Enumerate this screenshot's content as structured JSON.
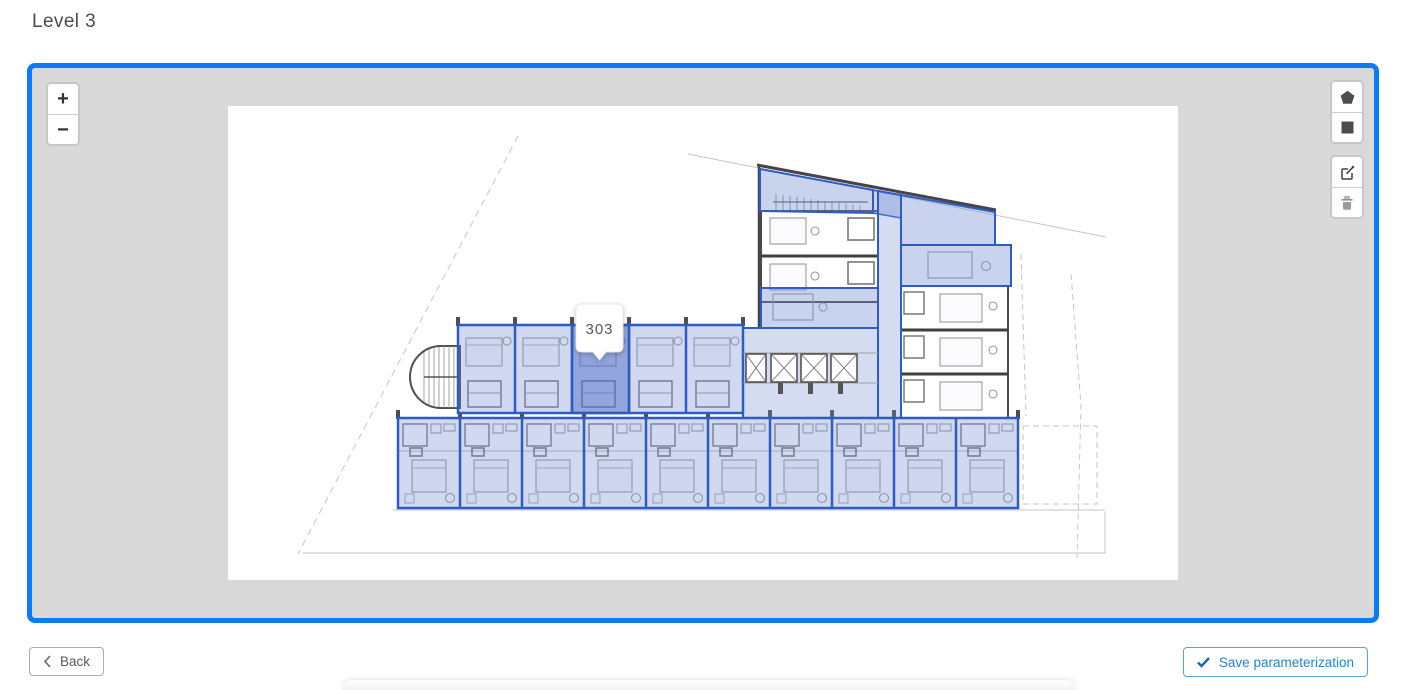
{
  "page": {
    "title": "Level 3"
  },
  "map": {
    "zoom": {
      "in_label": "+",
      "out_label": "−"
    },
    "tooltip": {
      "room_label": "303"
    },
    "tools": {
      "polygon": "draw-polygon",
      "rectangle": "draw-rectangle",
      "edit": "edit-layers",
      "delete": "delete-layers"
    }
  },
  "footer": {
    "back_label": "Back",
    "save_label": "Save parameterization"
  },
  "colors": {
    "map_border": "#0a7cf7",
    "map_background": "#d9d9d9",
    "room_highlight_stroke": "#2e5bc6",
    "room_highlight_fill": "rgba(112,140,210,0.35)",
    "selected_room_fill": "rgba(72,102,196,0.45)",
    "save_button_blue": "#1f87cc"
  }
}
